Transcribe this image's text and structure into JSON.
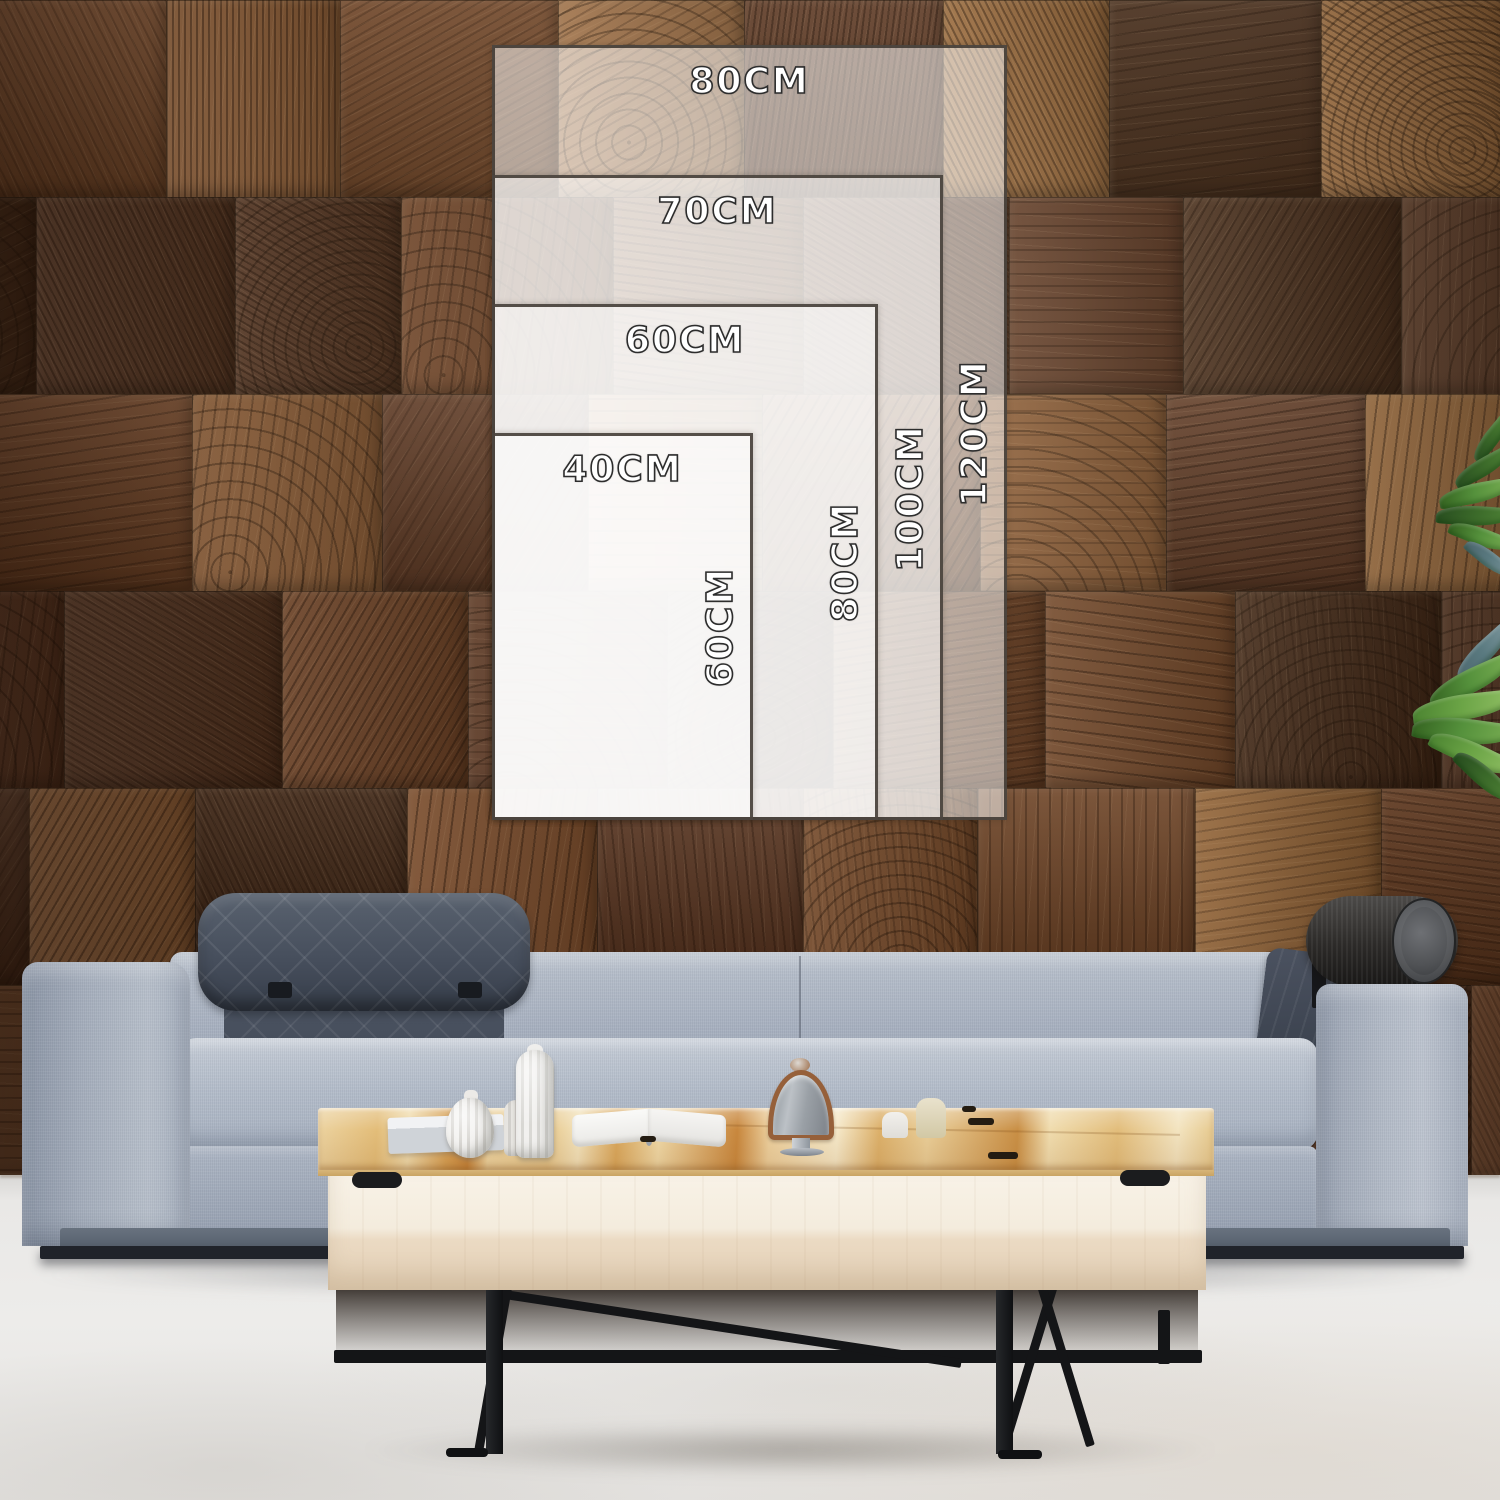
{
  "size_chart": {
    "unit": "CM",
    "sizes": [
      {
        "width_cm": 80,
        "height_cm": 120,
        "width_label": "80CM",
        "height_label": "120CM"
      },
      {
        "width_cm": 70,
        "height_cm": 100,
        "width_label": "70CM",
        "height_label": "100CM"
      },
      {
        "width_cm": 60,
        "height_cm": 80,
        "width_label": "60CM",
        "height_label": "80CM"
      },
      {
        "width_cm": 40,
        "height_cm": 60,
        "width_label": "40CM",
        "height_label": "60CM"
      }
    ]
  },
  "scene": {
    "setting": "living-room",
    "objects": [
      "wood-block-wall",
      "gray-fabric-sofa",
      "wooden-coffee-table",
      "potted-plant-leaves",
      "light-marble-floor",
      "vases",
      "books",
      "bell-cloche",
      "candles"
    ]
  },
  "colors": {
    "overlay_fill": "rgba(255,255,255,0.53)",
    "overlay_border": "#3e3730",
    "label_fill": "#ffffff",
    "label_outline": "#2d2d2d",
    "wood_palette": [
      "#7a4c2a",
      "#6b3f22",
      "#8a5a33",
      "#5a3520",
      "#9c6b3b",
      "#4c2d1a",
      "#82512e",
      "#714526",
      "#a5754a",
      "#3f2513"
    ],
    "sofa_fabric": "#a9b2bf",
    "sofa_headrest": "#454d5b",
    "sofa_bolster": "#2c2a28",
    "table_top": "#e3bd79",
    "table_face": "#f1e8d8",
    "metal_leg": "#141517",
    "floor": "#eae9e6",
    "plant_green": "#55913c"
  }
}
